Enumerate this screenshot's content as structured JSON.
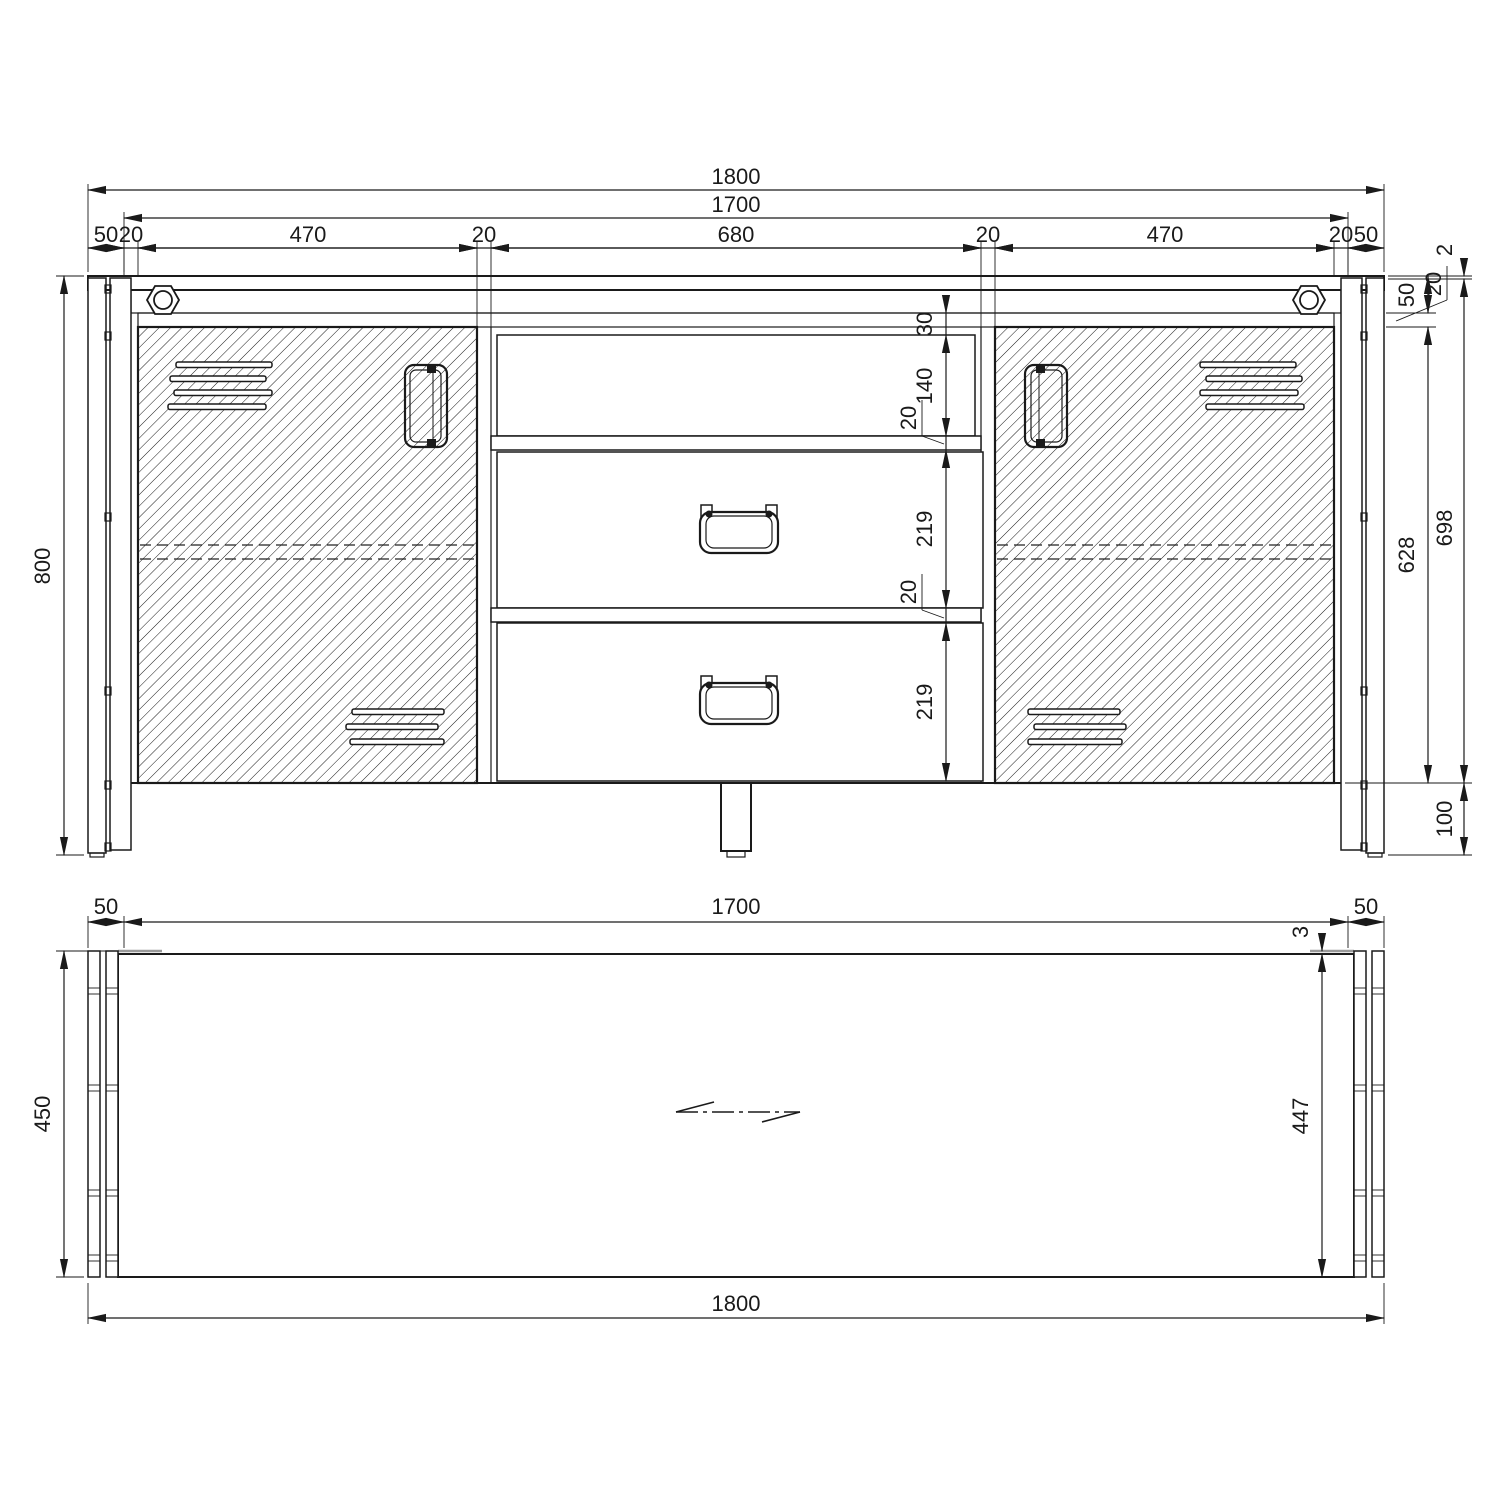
{
  "front_view": {
    "dim_total_width": "1800",
    "dim_inner_width": "1700",
    "width_chain": [
      "50",
      "20",
      "470",
      "20",
      "680",
      "20",
      "470",
      "20",
      "50"
    ],
    "dim_height": "800",
    "height_chain": [
      "30",
      "140",
      "20",
      "219",
      "20",
      "219"
    ],
    "right_dims": {
      "top_step": "2",
      "top_rail": "50",
      "top_board": "20",
      "opening_height": "628",
      "body_height": "698",
      "leg_height": "100"
    }
  },
  "plan_view": {
    "dim_left_leg": "50",
    "dim_inner_width": "1700",
    "dim_right_leg": "50",
    "dim_total_width": "1800",
    "dim_depth": "450",
    "dim_step": "3",
    "dim_inner_depth": "447"
  }
}
